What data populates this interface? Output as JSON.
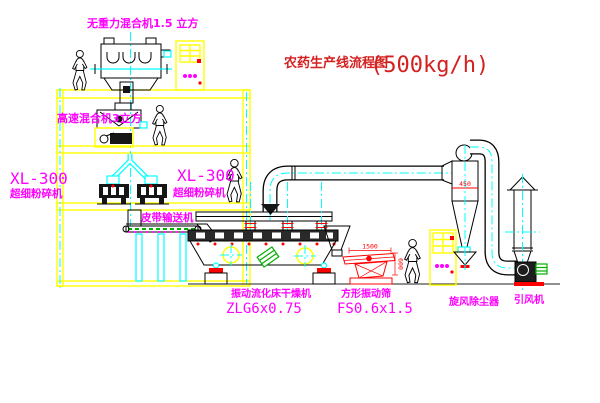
{
  "title": {
    "text": "农药生产线流程图",
    "capacity": "(500kg/h)"
  },
  "labels": {
    "gravity_mixer": "无重力混合机1.5 立方",
    "high_speed_mixer": "高速混合机3立方",
    "mill_left_model": "XL-300",
    "mill_left_name": "超细粉碎机",
    "mill_center_model": "XL-300",
    "mill_center_name": "超细粉碎机",
    "belt_conveyor": "皮带输送机",
    "dryer_name": "振动流化床干燥机",
    "dryer_model": "ZLG6x0.75",
    "screen_name": "方形振动筛",
    "screen_model": "FS0.6x1.5",
    "cyclone": "旋风除尘器",
    "fan": "引风机"
  },
  "dimensions": {
    "screen_length": "1500",
    "screen_height": "600",
    "cyclone_band": "450"
  },
  "colors": {
    "struct": "#ffff00",
    "center": "#00ffff",
    "label": "#ff00ff",
    "title": "#d42020",
    "dim": "#ff0000",
    "green": "#00b000"
  }
}
